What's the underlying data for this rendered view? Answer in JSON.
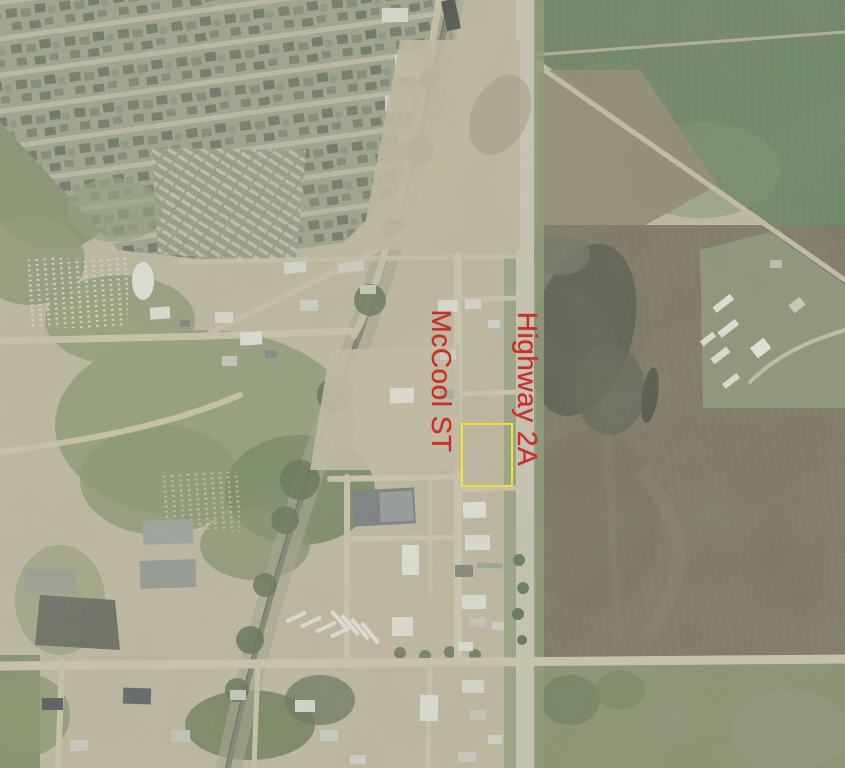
{
  "map": {
    "kind": "aerial-photo",
    "labels": [
      {
        "id": "street-label",
        "text": "McCool ST",
        "color": "#d32a23",
        "rotation_deg": 90
      },
      {
        "id": "highway-label",
        "text": "Highway 2A",
        "color": "#d32a23",
        "rotation_deg": 90
      }
    ],
    "highlight": {
      "shape": "rectangle",
      "stroke": "#efe42b",
      "description": "yellow outline around vacant parcel east of McCool ST, west of Highway 2A"
    },
    "annotation_colors": {
      "label_red": "#d32a23",
      "parcel_yellow": "#efe42b"
    }
  }
}
